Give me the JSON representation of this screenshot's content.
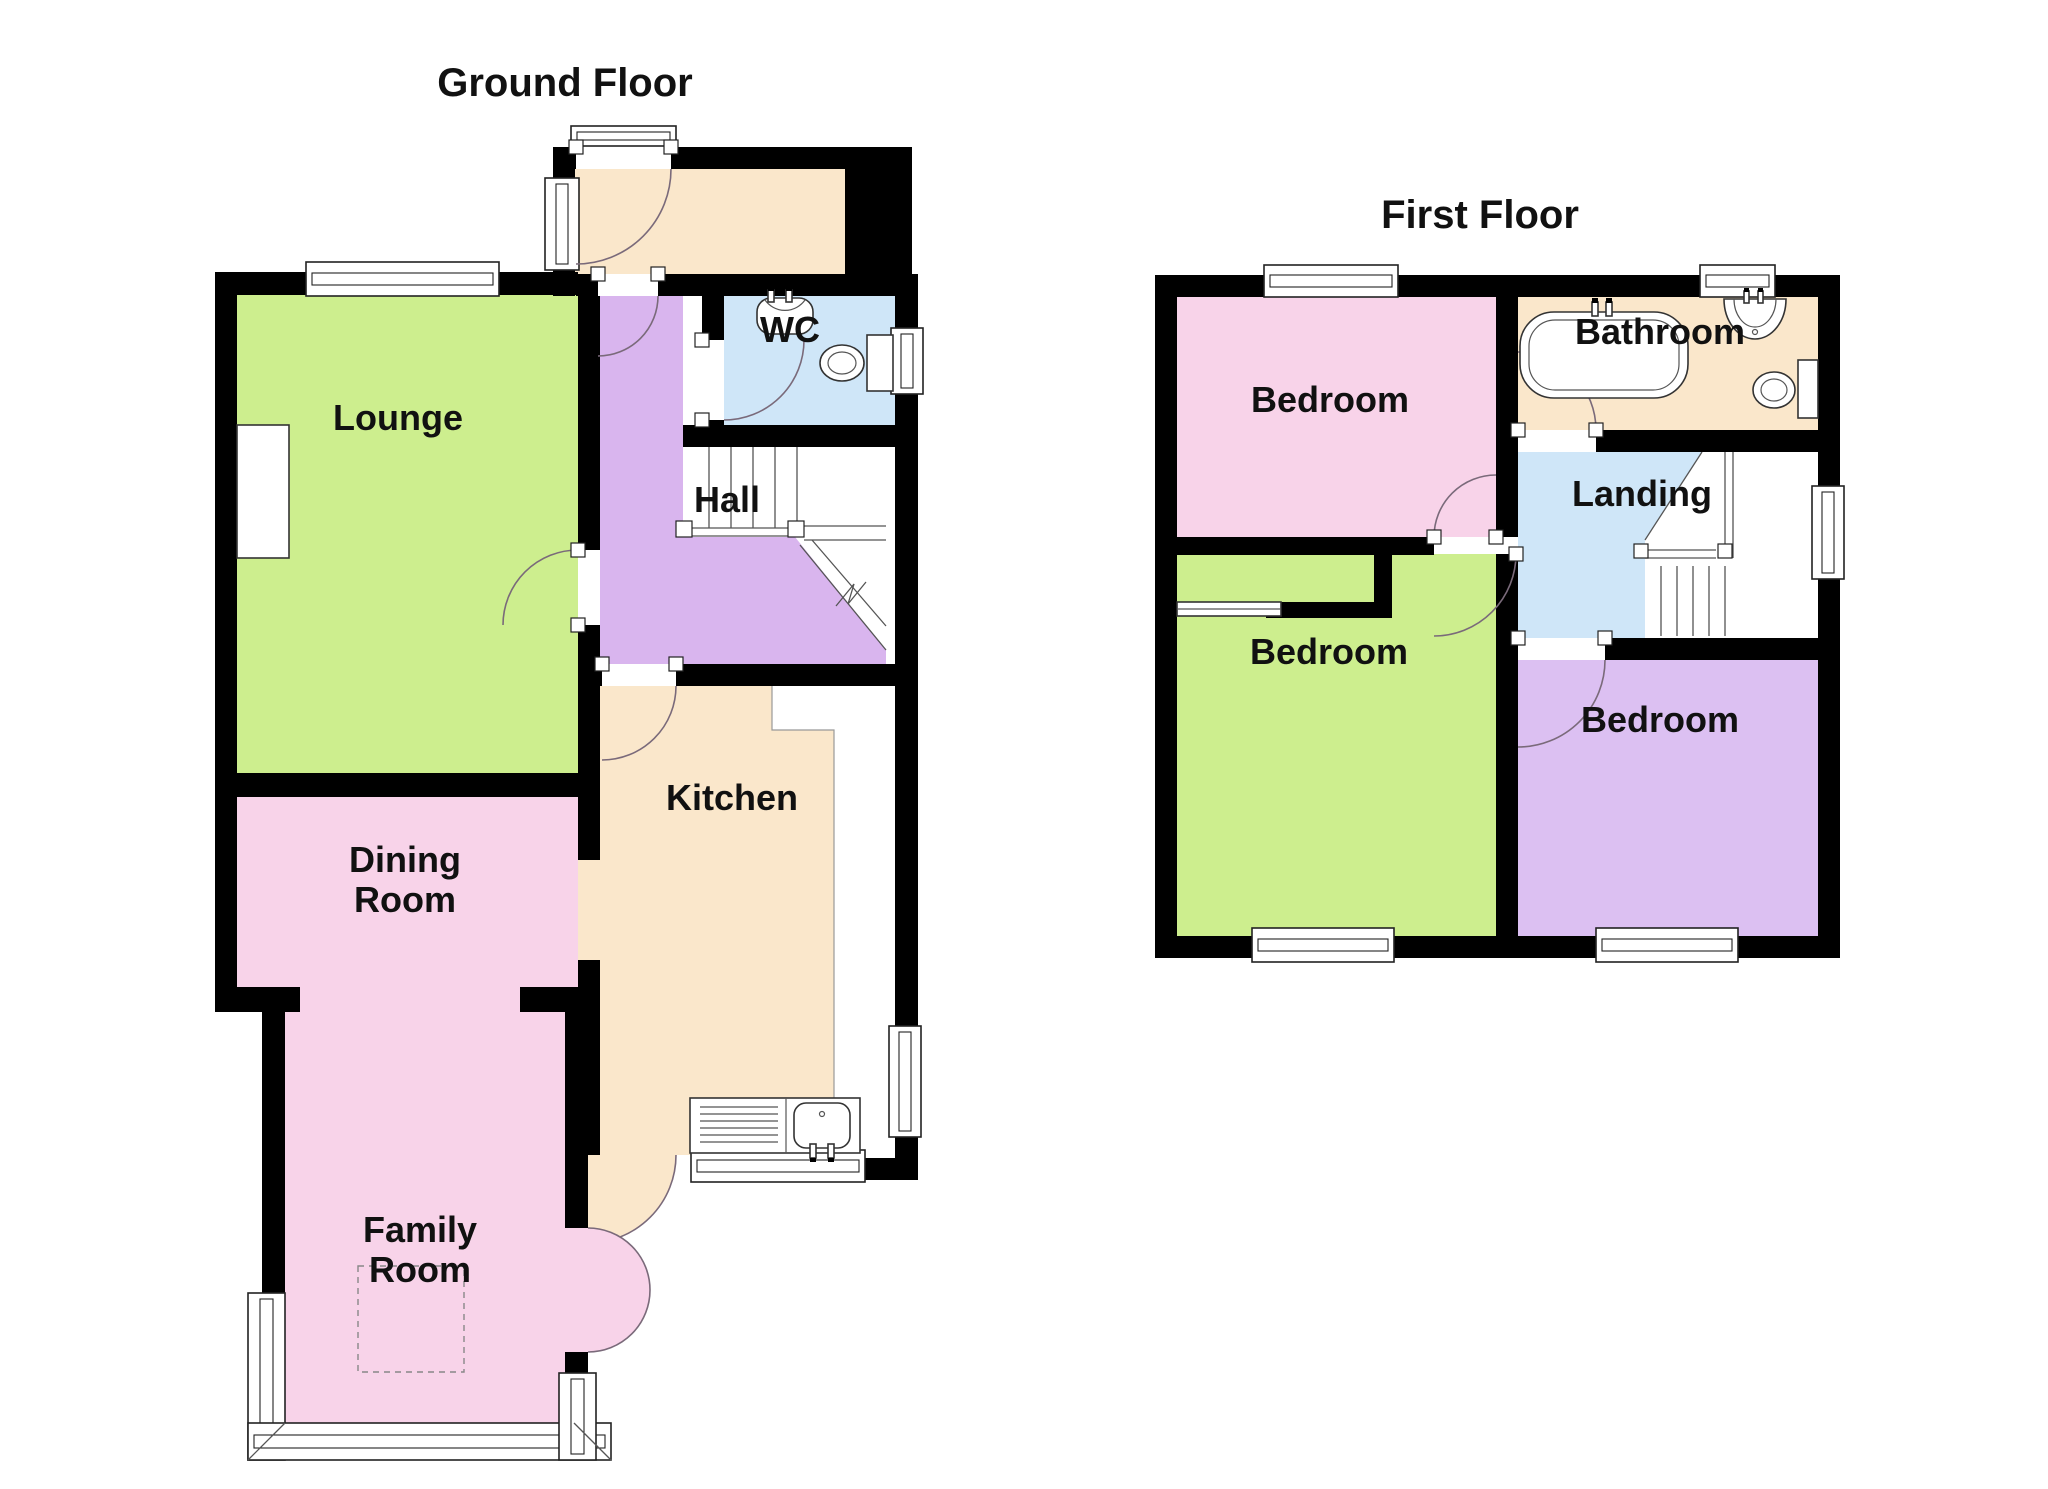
{
  "ground_floor": {
    "title": "Ground Floor",
    "rooms": {
      "lounge": "Lounge",
      "hall": "Hall",
      "wc": "WC",
      "kitchen": "Kitchen",
      "dining": {
        "line1": "Dining",
        "line2": "Room"
      },
      "family": {
        "line1": "Family",
        "line2": "Room"
      }
    }
  },
  "first_floor": {
    "title": "First Floor",
    "rooms": {
      "bedroom_front": "Bedroom",
      "bedroom_middle": "Bedroom",
      "bedroom_back": "Bedroom",
      "bathroom": "Bathroom",
      "landing": "Landing"
    }
  },
  "colors": {
    "room_green": "#cdee8e",
    "room_pink": "#f8d3e9",
    "hall_purple": "#d9b5ee",
    "bedroom_purple": "#dcc0f2",
    "room_blue": "#cfe6f8",
    "room_cream": "#fae7cb",
    "wall": "#000000"
  },
  "icons": {
    "stairs": "stairs-icon",
    "bathtub": "bathtub-icon",
    "toilet": "toilet-icon",
    "sink": "sink-icon",
    "kitchen_sink": "kitchen-sink-icon",
    "window": "window-icon",
    "door": "door-arc-icon",
    "fireplace": "fireplace-icon",
    "wardrobe": "wardrobe-slider-icon"
  }
}
